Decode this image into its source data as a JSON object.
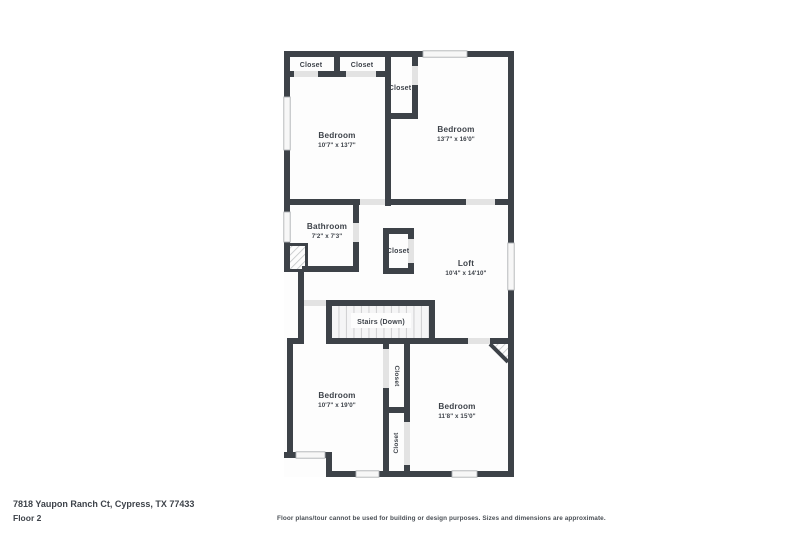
{
  "colors": {
    "wall": "#3d4248",
    "text": "#3e434a",
    "floor": "#fdfdfd",
    "door_gap": "#e3e3e3",
    "window_fill": "#f7f7f7",
    "window_stroke": "#b0b3b5",
    "hatch_line": "#c2c5c7",
    "tread_bg": "#f5f5f6",
    "tread_line": "#d2d2d4"
  },
  "rooms": {
    "bedroom_tl": {
      "label": "Bedroom",
      "dims": "10'7\" x 13'7\""
    },
    "bedroom_tr": {
      "label": "Bedroom",
      "dims": "13'7\" x 16'0\""
    },
    "bathroom": {
      "label": "Bathroom",
      "dims": "7'2\" x 7'3\""
    },
    "loft": {
      "label": "Loft",
      "dims": "10'4\" x 14'10\""
    },
    "bedroom_bl": {
      "label": "Bedroom",
      "dims": "10'7\" x 19'0\""
    },
    "bedroom_br": {
      "label": "Bedroom",
      "dims": "11'8\" x 15'0\""
    },
    "stairs": {
      "label": "Stairs (Down)"
    }
  },
  "closets": {
    "top_left_1": "Closet",
    "top_left_2": "Closet",
    "bedroom_tr_closet": "Closet",
    "loft_closet": "Closet",
    "bedroom_bl_closet": "Closet",
    "bedroom_br_closet": "Closet"
  },
  "footer": {
    "address": "7818 Yaupon Ranch Ct, Cypress, TX 77433",
    "floor_label": "Floor 2",
    "disclaimer": "Floor plans/tour cannot be used for building or design purposes. Sizes and dimensions are approximate."
  }
}
